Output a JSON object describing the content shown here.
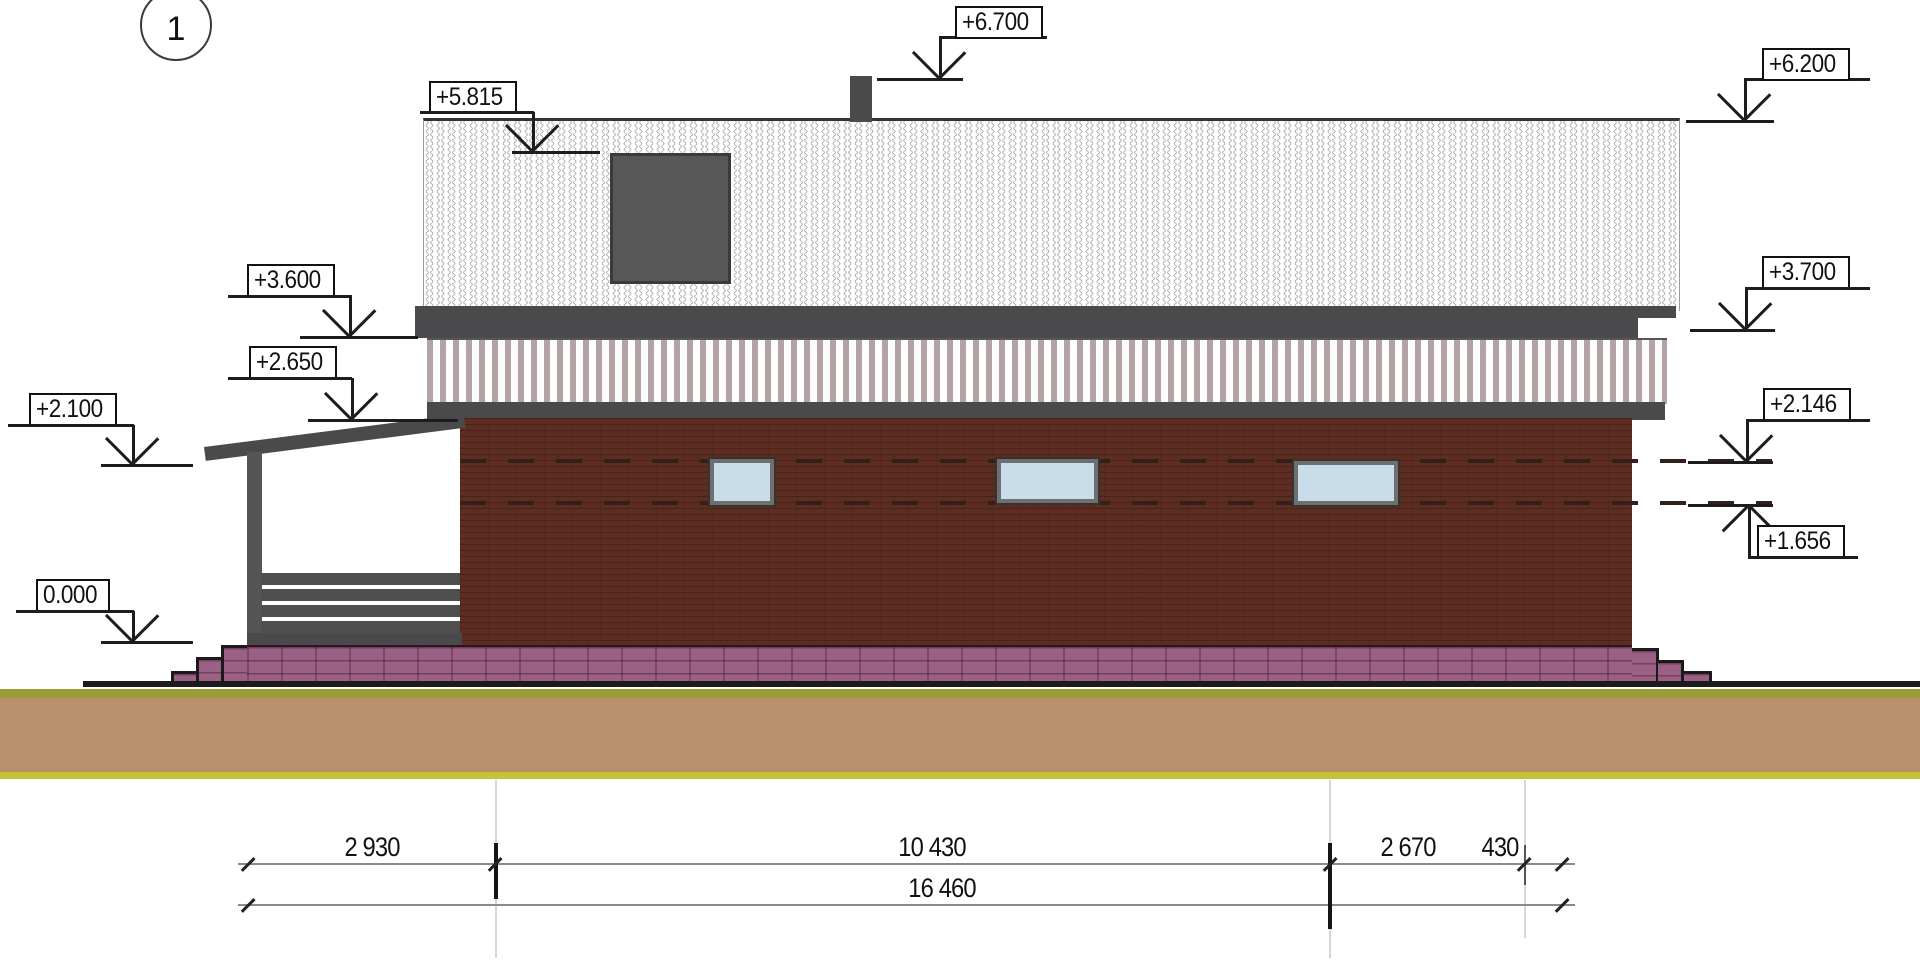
{
  "drawing": {
    "sheet_marker": "1",
    "levels": [
      {
        "id": "ridge",
        "label": "+6.700"
      },
      {
        "id": "roof-edge-right",
        "label": "+6.200"
      },
      {
        "id": "skylight-top",
        "label": "+5.815"
      },
      {
        "id": "eaves-left",
        "label": "+3.600"
      },
      {
        "id": "band-bottom-left",
        "label": "+2.650"
      },
      {
        "id": "porch-roof-edge",
        "label": "+2.100"
      },
      {
        "id": "ground-floor",
        "label": "0.000"
      },
      {
        "id": "eaves-right",
        "label": "+3.700"
      },
      {
        "id": "window-head-right",
        "label": "+2.146"
      },
      {
        "id": "window-sill-right",
        "label": "+1.656"
      }
    ],
    "dimensions": {
      "segments": [
        {
          "label": "2 930"
        },
        {
          "label": "10 430"
        },
        {
          "label": "2 670"
        },
        {
          "label": "430"
        }
      ],
      "total": {
        "label": "16 460"
      }
    },
    "colors": {
      "brick": "#5d2d21",
      "plinth": "#9b6184",
      "stripe": "#b3a3a5",
      "dark_trim": "#4a4a4c",
      "window_glass": "#c9dcea",
      "ground_tan": "#b8906b",
      "ground_olive": "#9a9b39",
      "ground_yellow": "#c6c135"
    }
  }
}
